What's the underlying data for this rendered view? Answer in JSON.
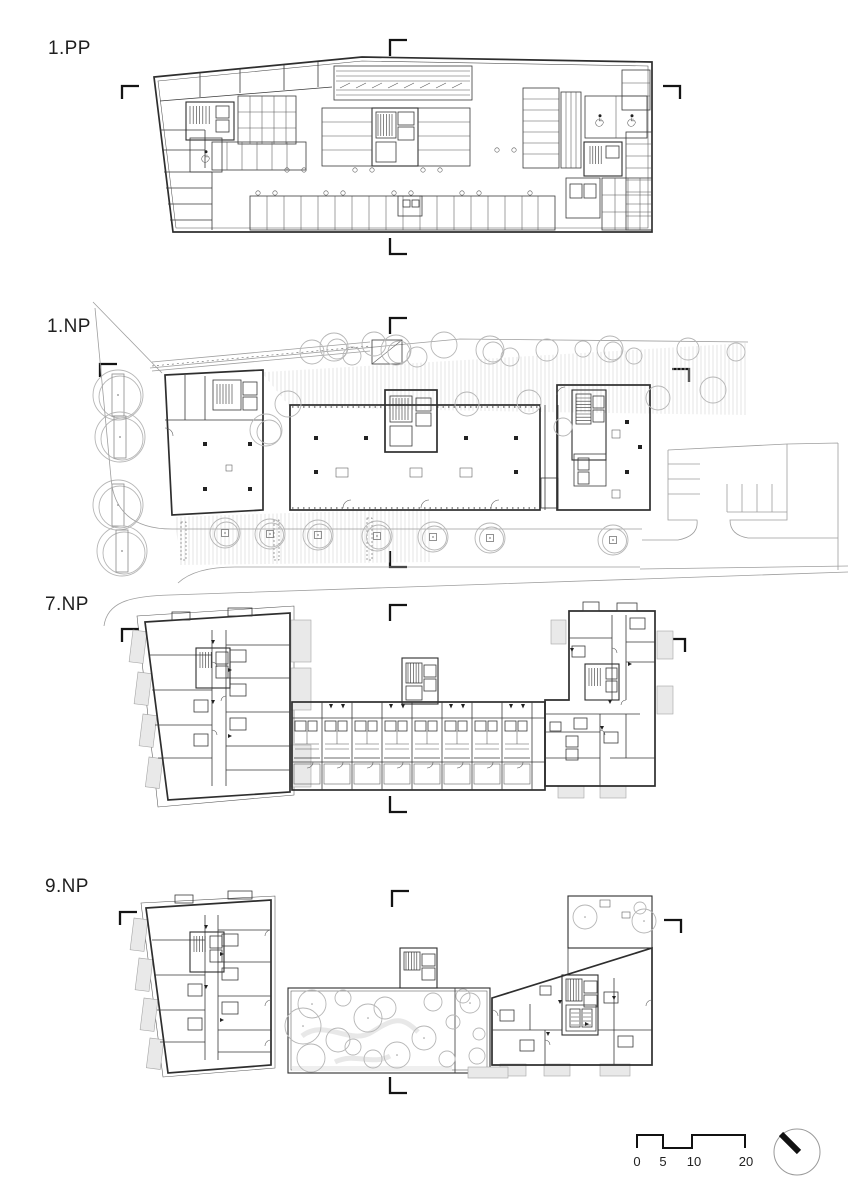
{
  "floors": [
    {
      "label": "1.PP"
    },
    {
      "label": "1.NP"
    },
    {
      "label": "7.NP"
    },
    {
      "label": "9.NP"
    }
  ],
  "scale_bar": {
    "ticks": [
      "0",
      "5",
      "10",
      "20"
    ]
  },
  "icons": {
    "north_arrow": "north-arrow-icon",
    "wheelchair": "wheelchair-icon",
    "tree": "tree-icon",
    "section_marker": "section-cut-marker-icon",
    "stairs": "stairs-hatch-icon",
    "elevator": "elevator-icon"
  },
  "colors": {
    "background": "#ffffff",
    "wall_line": "#2e2e2e",
    "thin_line": "#555555",
    "site_line": "#9e9e9e",
    "tree_line": "#b6b6b6",
    "balcony_fill": "#e9e9e9",
    "marker": "#141414"
  }
}
